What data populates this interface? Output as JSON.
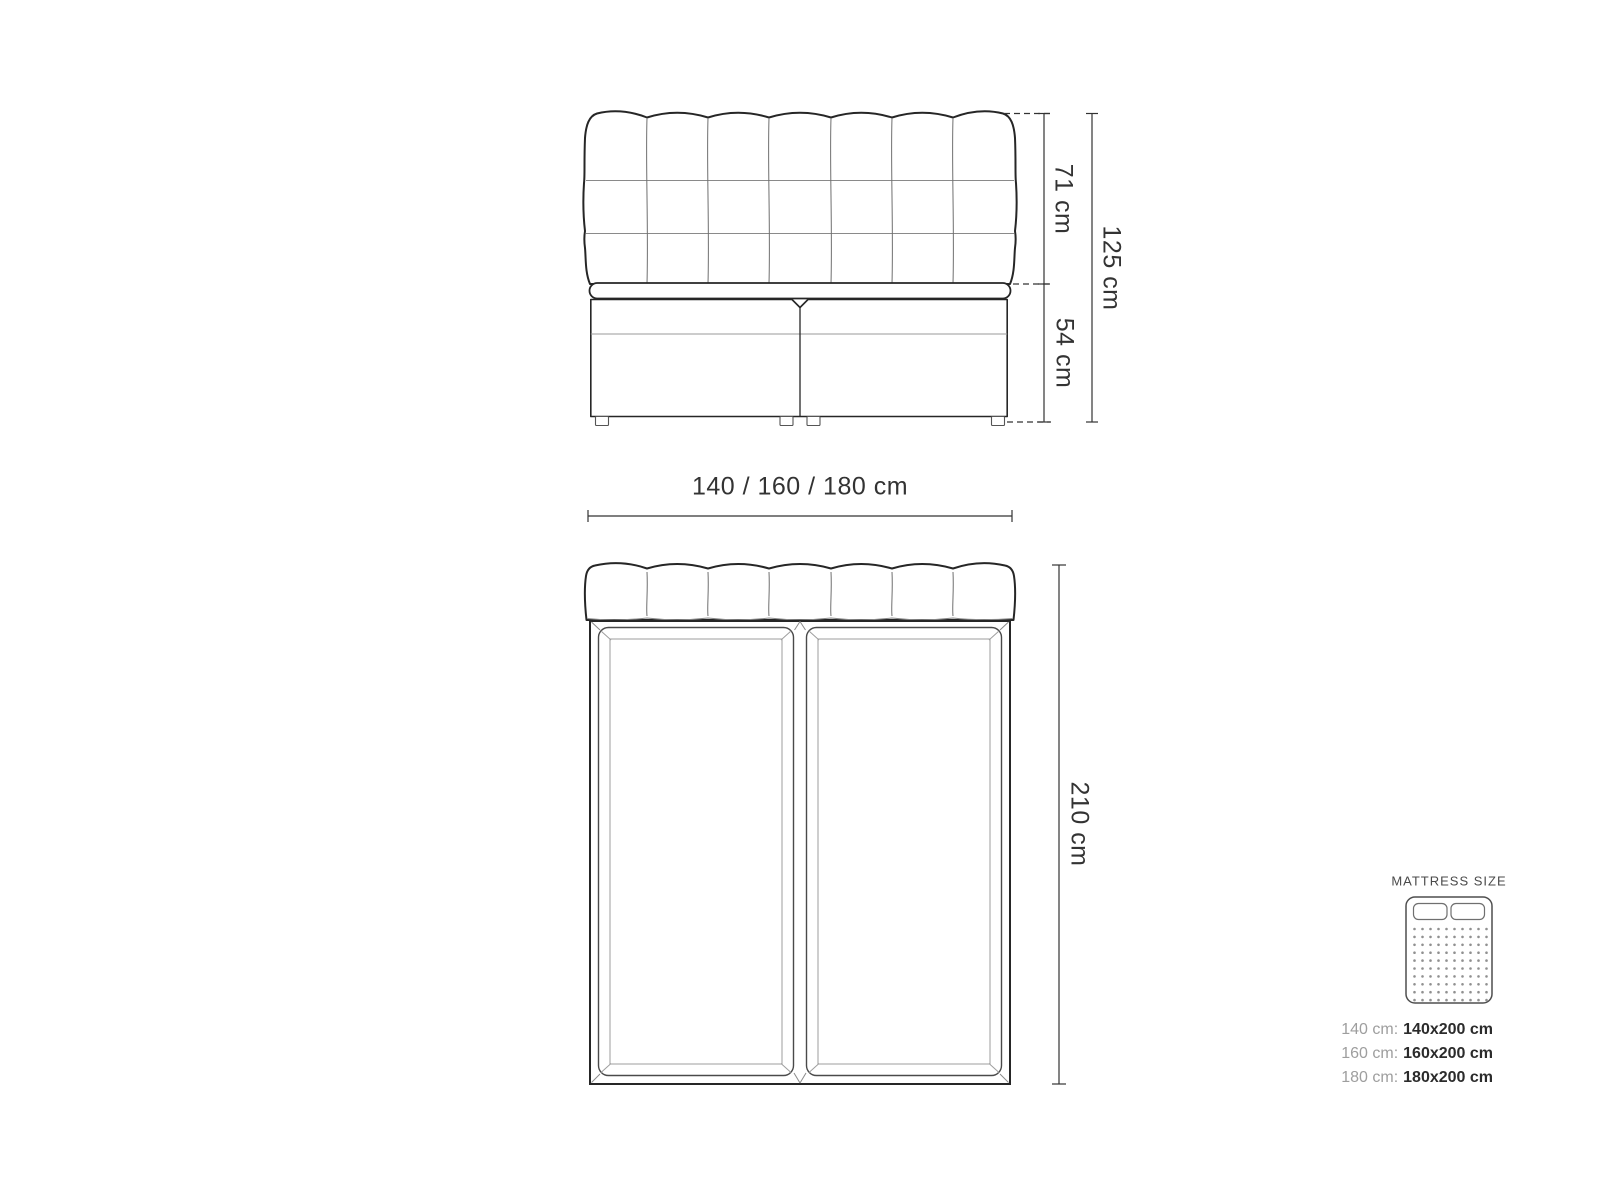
{
  "diagram": {
    "front_view": {
      "headboard_height": "71 cm",
      "base_height": "54 cm",
      "total_height": "125 cm",
      "width_options": "140 / 160 / 180 cm"
    },
    "top_view": {
      "length": "210 cm"
    },
    "legend": {
      "title": "MATTRESS SIZE",
      "rows": [
        {
          "label": "140 cm:",
          "value": "140x200 cm"
        },
        {
          "label": "160 cm:",
          "value": "160x200 cm"
        },
        {
          "label": "180 cm:",
          "value": "180x200 cm"
        }
      ]
    },
    "colors": {
      "outline": "#262626",
      "seam": "#8a8a8a",
      "dimension_line": "#333333",
      "label_text": "#333333",
      "legend_muted": "#9e9e9e",
      "background": "#ffffff"
    }
  }
}
